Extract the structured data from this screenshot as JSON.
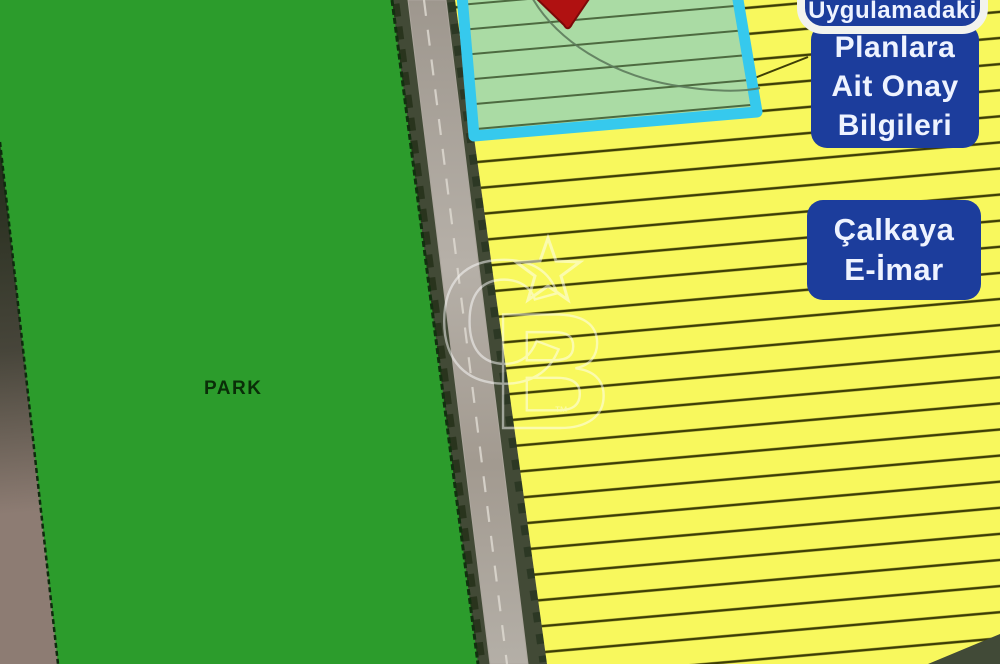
{
  "map": {
    "park_label": "PARK",
    "watermark": {
      "letter_c": "C",
      "letter_b": "B",
      "tm": "™"
    }
  },
  "badges": {
    "plan_approval_top": {
      "label": "Uygulamadaki"
    },
    "plan_approval": {
      "lines": [
        "Planlara",
        "Ait Onay",
        "Bilgileri"
      ]
    },
    "eimar": {
      "lines": [
        "Çalkaya",
        "E-İmar"
      ]
    }
  },
  "colors": {
    "badge_blue": "#1c3d9c",
    "badge_text": "#eef3ff",
    "badge_border_white": "#f2f3ee",
    "park_green": "#2c9c2c",
    "park_label_color": "#0a2e08",
    "zone_yellow": "#f8f85d",
    "zone_hatch": "#3e3e05",
    "plan_green_fill": "#aadba4",
    "plan_green_hatch": "#4d6a40",
    "plan_border_cyan": "#36c9ed",
    "pin_red": "#b01111",
    "curve_line": "#5d7b5c",
    "road_asphalt": "#aca69d",
    "watermark_white": "#ffffff"
  }
}
